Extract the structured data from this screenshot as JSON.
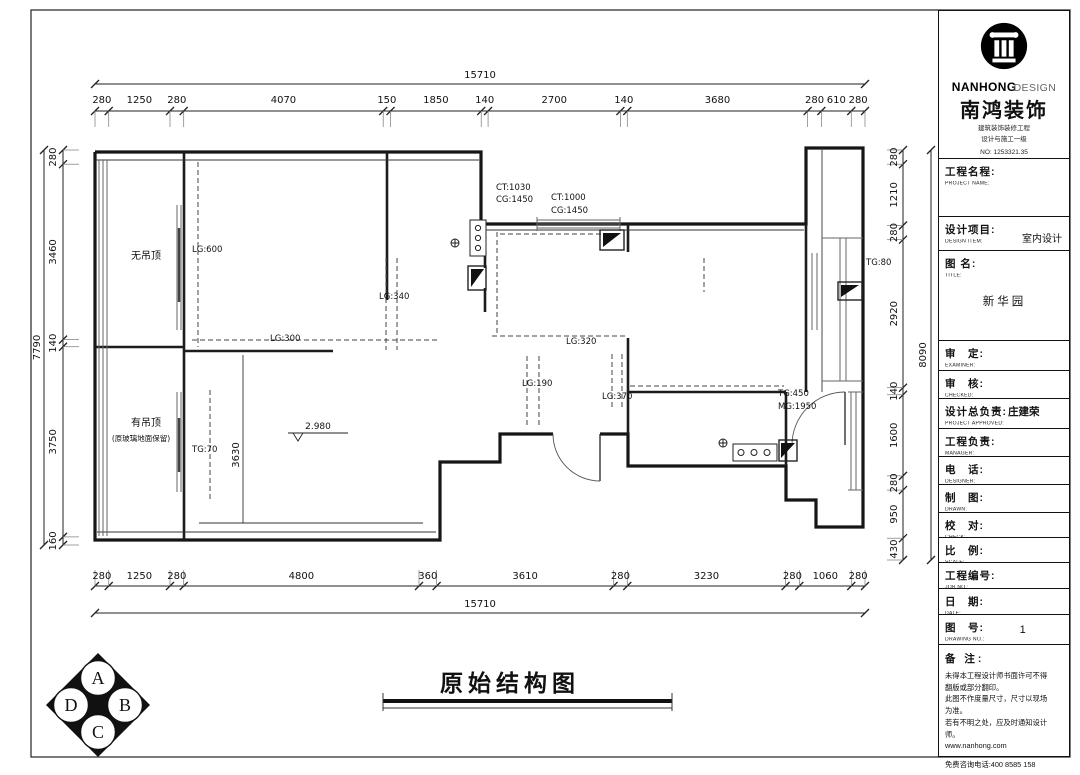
{
  "sheet": {
    "drawing_title": "原始结构图",
    "line_color": "#1a1a1a",
    "paper_color": "#ffffff"
  },
  "plan": {
    "labels": {
      "no_ceiling": "无吊顶",
      "has_ceiling": "有吊顶",
      "has_ceiling_note": "(原玻璃地面保留)",
      "lg600": "LG:600",
      "lg340": "LG:340",
      "lg300": "LG:300",
      "lg320": "LG:320",
      "lg190": "LG:190",
      "lg370": "LG:370",
      "ct1030": "CT:1030",
      "cg1450a": "CG:1450",
      "ct1000": "CT:1000",
      "cg1450b": "CG:1450",
      "tg80": "TG:80",
      "tg70": "TG:70",
      "tg450": "TG:450",
      "mg1950": "MG:1950",
      "dim3630": "3630",
      "elev2980": "2.980"
    },
    "dimension_chains": {
      "top": {
        "overall": "15710",
        "segments": [
          "280",
          "1250",
          "280",
          "4070",
          "150",
          "1850",
          "140",
          "2700",
          "140",
          "3680",
          "280",
          "610",
          "280"
        ]
      },
      "bottom": {
        "overall": "15710",
        "segments": [
          "280",
          "1250",
          "280",
          "4800",
          "360",
          "3610",
          "280",
          "3230",
          "280",
          "1060",
          "280"
        ]
      },
      "left": {
        "overall": "7790",
        "segments": [
          "280",
          "3460",
          "140",
          "3750",
          "160"
        ]
      },
      "right": {
        "overall": "8090",
        "segments": [
          "280",
          "1210",
          "280",
          "2920",
          "140",
          "1600",
          "280",
          "950",
          "430"
        ]
      }
    },
    "grid_badge": [
      "A",
      "B",
      "C",
      "D"
    ]
  },
  "title_block": {
    "brand": {
      "logo_en_bold": "NANHONG",
      "logo_en_light": "DESIGN",
      "company_cn": "南鸿装饰",
      "cert_line1": "建筑装饰装修工程",
      "cert_line2": "设计与施工一级",
      "cert_no": "NO: 1253321.35"
    },
    "rows": [
      {
        "cn": "工程名程:",
        "en": "PROJECT NAME:",
        "value": ""
      },
      {
        "cn": "设计项目:",
        "en": "DESIGN ITEM:",
        "value": "室内设计"
      },
      {
        "cn": "图 名:",
        "en": "TITLE:",
        "value": "新华园"
      },
      {
        "cn": "审　定:",
        "en": "EXAMINER:",
        "value": ""
      },
      {
        "cn": "审　核:",
        "en": "CHECKED:",
        "value": ""
      },
      {
        "cn": "设计总负责:",
        "en": "PROJECT APPROVED:",
        "value": "庄建荣"
      },
      {
        "cn": "工程负责:",
        "en": "MANAGER:",
        "value": ""
      },
      {
        "cn": "电　话:",
        "en": "DESIGNER:",
        "value": ""
      },
      {
        "cn": "制　图:",
        "en": "DRAWN:",
        "value": ""
      },
      {
        "cn": "校　对:",
        "en": "CHECK:",
        "value": ""
      },
      {
        "cn": "比　例:",
        "en": "SCALE:",
        "value": ""
      },
      {
        "cn": "工程编号:",
        "en": "JOB NO.:",
        "value": ""
      },
      {
        "cn": "日　期:",
        "en": "DATE:",
        "value": ""
      },
      {
        "cn": "图　号:",
        "en": "DRAWING NO.:",
        "value": "1"
      }
    ],
    "notes": {
      "label": "备 注:",
      "lines": [
        "未得本工程设计师书面许可不得",
        "翻版或部分翻印。",
        "此图不作度量尺寸，尺寸以现场",
        "为准。",
        "若有不明之处，应及时通知设计",
        "师。",
        "www.nanhong.com",
        "免费咨询电话:400 8585 158"
      ]
    }
  }
}
